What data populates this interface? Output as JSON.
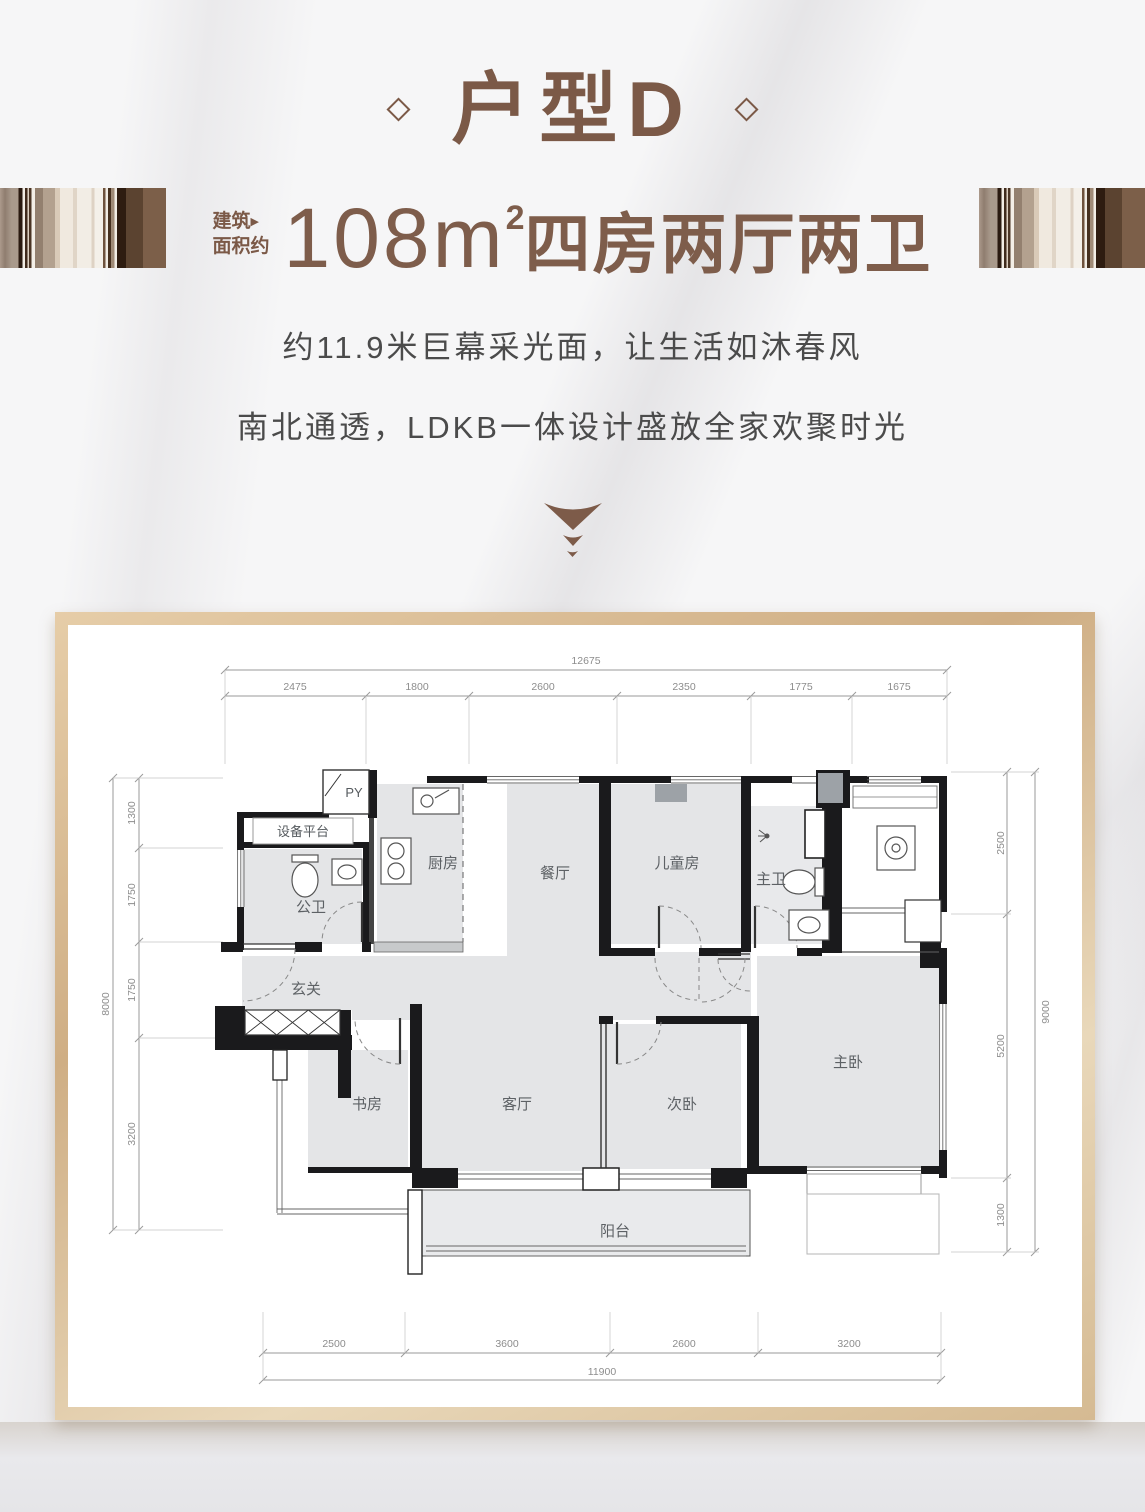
{
  "header": {
    "title": "户型D",
    "area_label_line1": "建筑",
    "area_label_tri": "▶",
    "area_label_line2": "面积约",
    "area_value": "108m",
    "area_sup": "2",
    "area_rooms": "四房两厅两卫",
    "tagline_line1": "约11.9米巨幕采光面，让生活如沐春风",
    "tagline_line2": "南北通透，LDKB一体设计盛放全家欢聚时光"
  },
  "colors": {
    "accent_brown": "#7b5947",
    "frame_gold": "#d3b28e",
    "wall_black": "#1a1a1c",
    "room_fill": "#e4e5e7",
    "dim_gray": "#8d8d8d"
  },
  "floorplan": {
    "rooms": {
      "equipment": "设备平台",
      "py": "PY",
      "guest_bath": "公卫",
      "kitchen": "厨房",
      "dining": "餐厅",
      "kids": "儿童房",
      "master_bath": "主卫",
      "foyer": "玄关",
      "study": "书房",
      "living": "客厅",
      "second_bed": "次卧",
      "master_bed": "主卧",
      "balcony": "阳台"
    },
    "dims": {
      "top": {
        "total": "12675",
        "segments": [
          "2475",
          "1800",
          "2600",
          "2350",
          "1775",
          "1675"
        ]
      },
      "left": {
        "total": "8000",
        "segments": [
          "1300",
          "1750",
          "1750",
          "3200"
        ]
      },
      "right": {
        "total": "9000",
        "segments": [
          "2500",
          "5200",
          "1300"
        ]
      },
      "bottom": {
        "total": "11900",
        "segments": [
          "2500",
          "3600",
          "2600",
          "3200"
        ]
      }
    }
  }
}
